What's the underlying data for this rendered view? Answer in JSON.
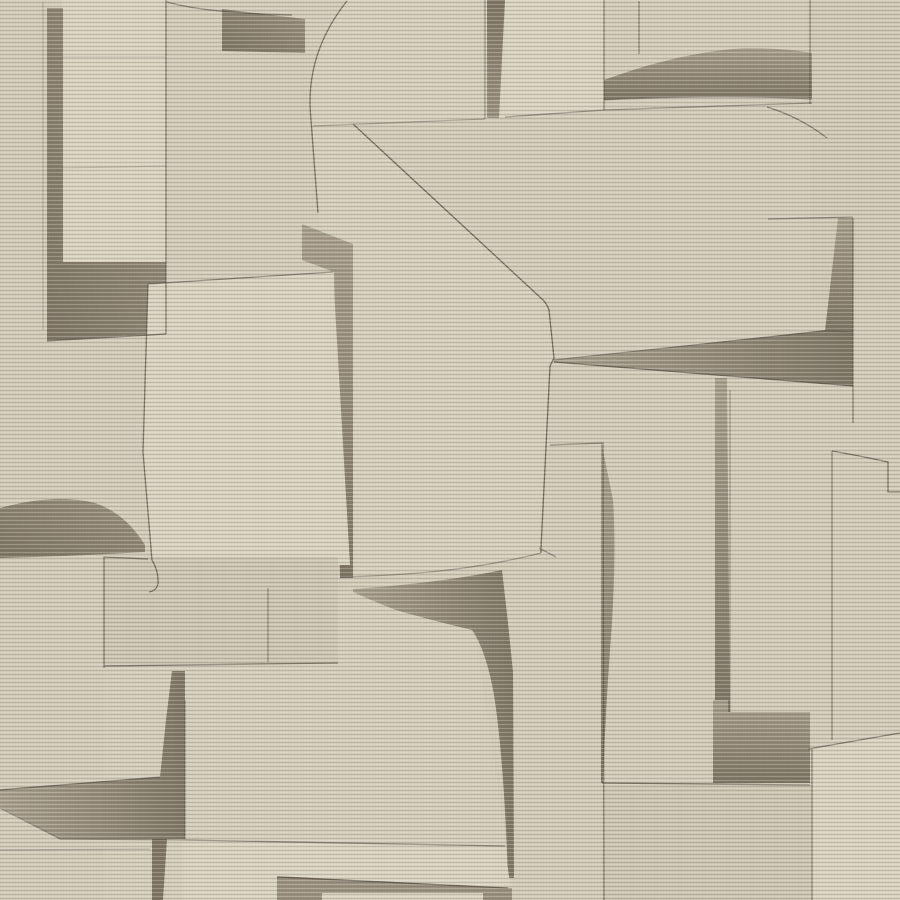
{
  "artwork": {
    "kind": "abstract-collage-wallpaper",
    "canvas": {
      "width": 900,
      "height": 900
    },
    "palette": {
      "base": "#d3cbba",
      "light": "#dad2c1",
      "slab": "#d6cebd",
      "pb": "#d5cdbc",
      "mid": "#cdc5b4",
      "taupe": "#9a9080",
      "taupe_light": "#a89e8d",
      "taupe_dark": "#7d7464",
      "outline": "#4e473b",
      "rib_light": "#fffef8",
      "rib_dark": "#5f5745"
    },
    "texture": {
      "rib_period_px": 4,
      "rib_light_opacity": 0.22,
      "rib_dark_opacity": 0.2,
      "thread_opacity": 0.035
    },
    "fills": [
      {
        "name": "background",
        "d": "M0,0 L900,0 L900,900 L0,900 Z",
        "fill": "base"
      },
      {
        "name": "panel-top-left",
        "d": "M62,0 L166,0 L166,265 L62,265 Z",
        "fill": "light"
      },
      {
        "name": "shadow-bar-band-top-left",
        "d": "M47,8 L63,8 L63,262 L166,262 L166,333 L47,341 Z",
        "fill": "grad_dl"
      },
      {
        "name": "panel-top-mid-left",
        "d": "M347,0 Q305,55 311,120 L313,126 L485,119 L485,0 Z",
        "fill": "slab"
      },
      {
        "name": "panel-top-mid-right",
        "d": "M485,0 L604,0 L604,110 L505,117 L485,119 Z",
        "fill": "light"
      },
      {
        "name": "shadow-strip-top-center",
        "d": "M487,0 L505,0 L499,118 L487,118 Z",
        "fill": "grad_vr"
      },
      {
        "name": "shadow-rect-top-left",
        "d": "M222,9 L305,19 L305,53 L222,51 Z",
        "fill": "grad_dl"
      },
      {
        "name": "panel-top-right",
        "d": "M810,0 L900,0 L900,300 L810,300 Z",
        "fill": "mid",
        "opacity": 0.45
      },
      {
        "name": "shadow-crescent-top-right",
        "d": "M604,80 Q680,52 745,48 Q785,48 812,53 L812,98 Q700,94 604,100 Z",
        "fill": "grad_v"
      },
      {
        "name": "central-slab",
        "d": "M313,125 L353,124 L543,300 Q547,304 549,310 L554,358 L550,366 L541,548 L541,553 Q490,566 430,572 Q385,576 340,577 L332,300 L318,213 Q313,165 313,125 Z",
        "fill": "slab"
      },
      {
        "name": "shadow-column-left-center",
        "d": "M302,224 L353,244 L353,578 L340,578 L334,272 L302,260 Z",
        "fill": "grad_v"
      },
      {
        "name": "panel-left-center",
        "d": "M148,284 L333,272 L350,565 L152,563 L143,452 Z",
        "fill": "light"
      },
      {
        "name": "shadow-crescent-mid-left",
        "d": "M0,508 Q55,493 95,503 Q125,513 145,545 L145,552 Q75,556 0,558 Z",
        "fill": "grad_dl"
      },
      {
        "name": "panel-rect-lower-left",
        "d": "M104,557 L338,557 L338,663 L104,666 Z",
        "fill": "mid"
      },
      {
        "name": "panel-bottom-center",
        "d": "M104,666 L338,663 L338,592 L353,591 Q430,620 470,628 L476,640 L512,884 L512,900 L104,900 Z",
        "fill": "pb"
      },
      {
        "name": "shadow-swoosh-center",
        "d": "M353,589 Q440,583 502,570 L508,623 L513,672 L514,878 L508,878 Q504,760 494,695 Q486,650 472,630 Q430,620 396,610 Q370,600 353,592 Z",
        "fill": "grad_h"
      },
      {
        "name": "shadow-column-right-center",
        "d": "M601,440 L613,500 Q617,560 610,650 Q605,720 603,783 L601,783 Z",
        "fill": "grad_v"
      },
      {
        "name": "panel-bottom-left",
        "d": "M183,840 L505,846 L512,900 L183,900 Z",
        "fill": "light"
      },
      {
        "name": "shadow-wedge-bottom-left",
        "d": "M0,789 L160,777 L166,720 L172,671 L185,671 L185,839 L60,839 L0,807 Z",
        "fill": "grad_h"
      },
      {
        "name": "shadow-strip-bottom-left",
        "d": "M152,839 L167,839 L163,900 L152,900 Z",
        "fill": "taupe_dark"
      },
      {
        "name": "shadow-band-bottom",
        "d": "M277,876 L512,888 L512,900 L277,900 Z",
        "fill": "taupe"
      },
      {
        "name": "panel-inset-bottom",
        "d": "M322,893 L483,893 L483,900 L322,900 Z",
        "fill": "light"
      },
      {
        "name": "shadow-wedge-right",
        "d": "M553,360 L825,330 L853,332 L853,386 L554,362 Z",
        "fill": "grad_h"
      },
      {
        "name": "shadow-column-right",
        "d": "M838,218 L853,218 L853,332 L825,331 Z",
        "fill": "grad_v"
      },
      {
        "name": "shadow-column-narrow-right",
        "d": "M715,378 L727,378 L730,712 L715,712 Z",
        "fill": "grad_v"
      },
      {
        "name": "shadow-block-bottom-right",
        "d": "M713,700 L728,700 L728,712 L810,712 L810,783 L713,783 Z",
        "fill": "grad_v"
      },
      {
        "name": "panel-bottom-right-mid",
        "d": "M602,785 L810,785 L810,900 L602,900 Z",
        "fill": "mid"
      },
      {
        "name": "panel-bottom-right",
        "d": "M812,749 L900,733 L900,900 L812,900 Z",
        "fill": "light"
      }
    ],
    "lines": [
      {
        "name": "edge-x166",
        "d": "M166,0 L166,334",
        "opacity": 0.65
      },
      {
        "name": "edge-curve-top-left",
        "d": "M167,2 Q205,13 292,15",
        "opacity": 0.6
      },
      {
        "name": "edge-band-bottom",
        "d": "M47,341 L166,334",
        "opacity": 0.7
      },
      {
        "name": "seam-panel1-a",
        "d": "M62,57 L166,57",
        "opacity": 0.2
      },
      {
        "name": "seam-panel1-b",
        "d": "M62,168 L166,166",
        "opacity": 0.2
      },
      {
        "name": "edge-x43",
        "d": "M43,2 L43,330",
        "opacity": 0.25
      },
      {
        "name": "crease-x485",
        "d": "M485,0 L485,119",
        "opacity": 0.5
      },
      {
        "name": "edge-horizontal-a",
        "d": "M313,126 L485,119",
        "opacity": 0.4
      },
      {
        "name": "edge-horizontal-b",
        "d": "M505,117 L604,110 L812,103",
        "opacity": 0.5
      },
      {
        "name": "edge-crescent-bottom",
        "d": "M604,100 Q720,94 812,99",
        "opacity": 0.5
      },
      {
        "name": "edge-curve-top-right",
        "d": "M767,107 Q800,117 827,138",
        "opacity": 0.6
      },
      {
        "name": "edge-x639",
        "d": "M639,1 L639,54",
        "opacity": 0.55
      },
      {
        "name": "edge-diagonal-center",
        "d": "M353,124 L543,300 Q547,304 549,310 L554,358 L550,366 L541,548 L541,553",
        "opacity": 0.75
      },
      {
        "name": "edge-slab-bottom",
        "d": "M541,553 Q490,566 430,572 Q385,576 340,577",
        "opacity": 0.45
      },
      {
        "name": "edge-step-center",
        "d": "M539,548 L556,557",
        "opacity": 0.5
      },
      {
        "name": "edge-curve-left",
        "d": "M347,1 Q304,55 311,120 L318,213",
        "opacity": 0.7
      },
      {
        "name": "edge-panel6-left",
        "d": "M148,284 L143,452 L152,560 Q159,572 158,584 Q156,591 149,592",
        "opacity": 0.7
      },
      {
        "name": "edge-panel6-top",
        "d": "M148,284 L333,272",
        "opacity": 0.6
      },
      {
        "name": "edge-panel7",
        "d": "M104,668 L104,557 L148,559 M104,666 L338,663",
        "opacity": 0.65
      },
      {
        "name": "edge-x268",
        "d": "M268,588 L268,662",
        "opacity": 0.5
      },
      {
        "name": "edge-wedge-bl-top",
        "d": "M0,790 L160,777",
        "opacity": 0.6
      },
      {
        "name": "edge-wedge-bl-bottom",
        "d": "M0,808 L60,839 L183,840",
        "opacity": 0.5
      },
      {
        "name": "edge-faint-bl",
        "d": "M0,850 L150,849",
        "opacity": 0.3
      },
      {
        "name": "edge-column-bl",
        "d": "M185,700 L185,839",
        "opacity": 0.5
      },
      {
        "name": "edge-panel8-top",
        "d": "M183,840 L505,846",
        "opacity": 0.6
      },
      {
        "name": "edge-band-bottom-top",
        "d": "M277,877 L508,888",
        "opacity": 0.7
      },
      {
        "name": "edge-step-right",
        "d": "M832,451 Q861,456 888,462 L888,492 L900,492",
        "opacity": 0.7
      },
      {
        "name": "edge-x853",
        "d": "M853,218 L853,423",
        "opacity": 0.6
      },
      {
        "name": "edge-y218",
        "d": "M768,219 L853,217",
        "opacity": 0.55
      },
      {
        "name": "edge-x832",
        "d": "M832,451 L832,740",
        "opacity": 0.55
      },
      {
        "name": "edge-wedge-right-top",
        "d": "M553,360 L825,331 L853,332",
        "opacity": 0.45
      },
      {
        "name": "edge-wedge-right-bottom",
        "d": "M554,362 L853,386",
        "opacity": 0.7
      },
      {
        "name": "edge-x604-top",
        "d": "M604,0 L604,110",
        "opacity": 0.6
      },
      {
        "name": "edge-x602",
        "d": "M550,445 L603,443 L604,900",
        "opacity": 0.6
      },
      {
        "name": "edge-x730",
        "d": "M730,390 L730,712",
        "opacity": 0.4
      },
      {
        "name": "edge-block-bottom",
        "d": "M602,783 L810,785",
        "opacity": 0.7
      },
      {
        "name": "edge-x812",
        "d": "M812,749 L812,900",
        "opacity": 0.6
      },
      {
        "name": "edge-diagonal-br",
        "d": "M808,749 L900,733",
        "opacity": 0.65
      },
      {
        "name": "edge-x810-top",
        "d": "M810,0 L810,104",
        "opacity": 0.55
      }
    ]
  }
}
